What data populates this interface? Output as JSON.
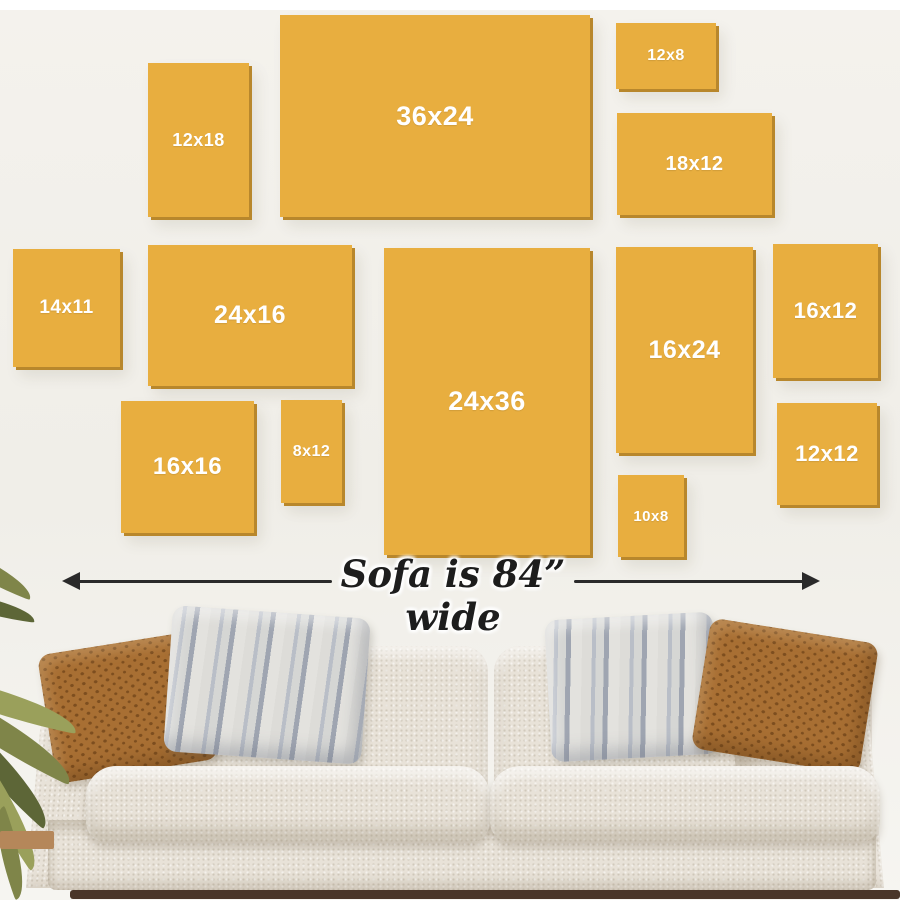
{
  "sofa_width_label": "Sofa is 84” wide",
  "frames": [
    {
      "label": "12x18",
      "x": 148,
      "y": 63,
      "w": 101,
      "h": 154,
      "font": 18
    },
    {
      "label": "36x24",
      "x": 280,
      "y": 15,
      "w": 310,
      "h": 202,
      "font": 27
    },
    {
      "label": "12x8",
      "x": 616,
      "y": 23,
      "w": 100,
      "h": 66,
      "font": 16
    },
    {
      "label": "18x12",
      "x": 617,
      "y": 113,
      "w": 155,
      "h": 102,
      "font": 20
    },
    {
      "label": "14x11",
      "x": 13,
      "y": 249,
      "w": 107,
      "h": 118,
      "font": 19
    },
    {
      "label": "24x16",
      "x": 148,
      "y": 245,
      "w": 204,
      "h": 141,
      "font": 25
    },
    {
      "label": "24x36",
      "x": 384,
      "y": 248,
      "w": 206,
      "h": 307,
      "font": 27
    },
    {
      "label": "16x24",
      "x": 616,
      "y": 247,
      "w": 137,
      "h": 206,
      "font": 25
    },
    {
      "label": "16x12",
      "x": 773,
      "y": 244,
      "w": 105,
      "h": 134,
      "font": 22
    },
    {
      "label": "16x16",
      "x": 121,
      "y": 401,
      "w": 133,
      "h": 132,
      "font": 24
    },
    {
      "label": "8x12",
      "x": 281,
      "y": 400,
      "w": 61,
      "h": 103,
      "font": 16
    },
    {
      "label": "10x8",
      "x": 618,
      "y": 475,
      "w": 66,
      "h": 82,
      "font": 15
    },
    {
      "label": "12x12",
      "x": 777,
      "y": 403,
      "w": 100,
      "h": 102,
      "font": 22
    }
  ],
  "colors": {
    "frame": "#E8AE3F",
    "frame_edge": "#B8872C",
    "frame_label": "#FFFFFF",
    "top_strip": "#FFFFFF",
    "wall": "#F1EFE9",
    "arrow": "#2A2A2A",
    "sofa_body": "#E8E2D8",
    "pillow_brown": "#A86F33",
    "pillow_brown_dark": "#7D4E1F",
    "pillow_stripe_light": "#DDDCD8",
    "pillow_stripe_dark": "#9FA5B1",
    "floor": "#4A3628",
    "pot": "#B5875A",
    "leaf_olive": "#7F8549",
    "leaf_dark": "#5D6637",
    "leaf_light": "#9AA05B"
  }
}
